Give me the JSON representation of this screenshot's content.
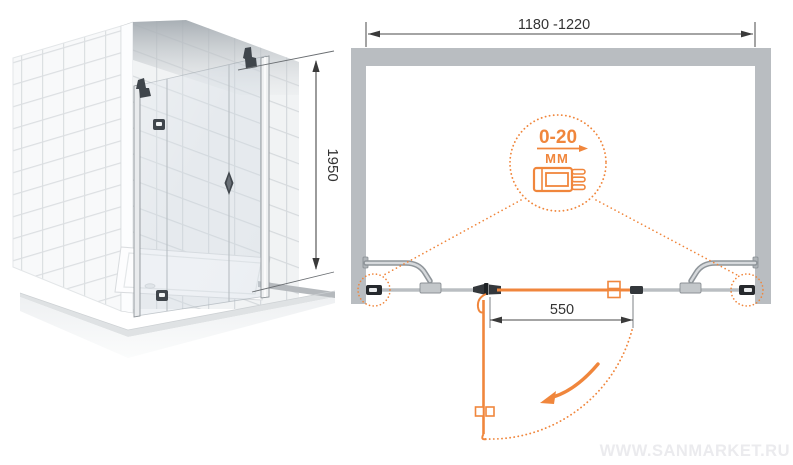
{
  "window": {
    "width": 793,
    "height": 465,
    "kind": "shower-door-technical-drawing"
  },
  "colors": {
    "accent_orange": "#F0863C",
    "wall_gray": "#B9BDC1",
    "metal_gray": "#9AA0A5",
    "hardware_dark": "#33373B",
    "dimension_line": "#4A4A4A",
    "text": "#333333",
    "tile_grout": "#DCDFE2",
    "watermark": "#EBEBEE"
  },
  "front_view": {
    "name": "shower-enclosure-3d-view",
    "height_dimension": {
      "value": "1950"
    }
  },
  "plan_view": {
    "name": "shower-door-plan-view",
    "width_dimension": {
      "value": "1180 -1220"
    },
    "door_width_dimension": {
      "value": "550"
    },
    "adjustment_callout": {
      "range": "0-20",
      "unit": "ММ",
      "icon": "adjustable-wall-profile-icon"
    }
  },
  "watermark": {
    "text": "WWW.SANMARKET.RU"
  }
}
